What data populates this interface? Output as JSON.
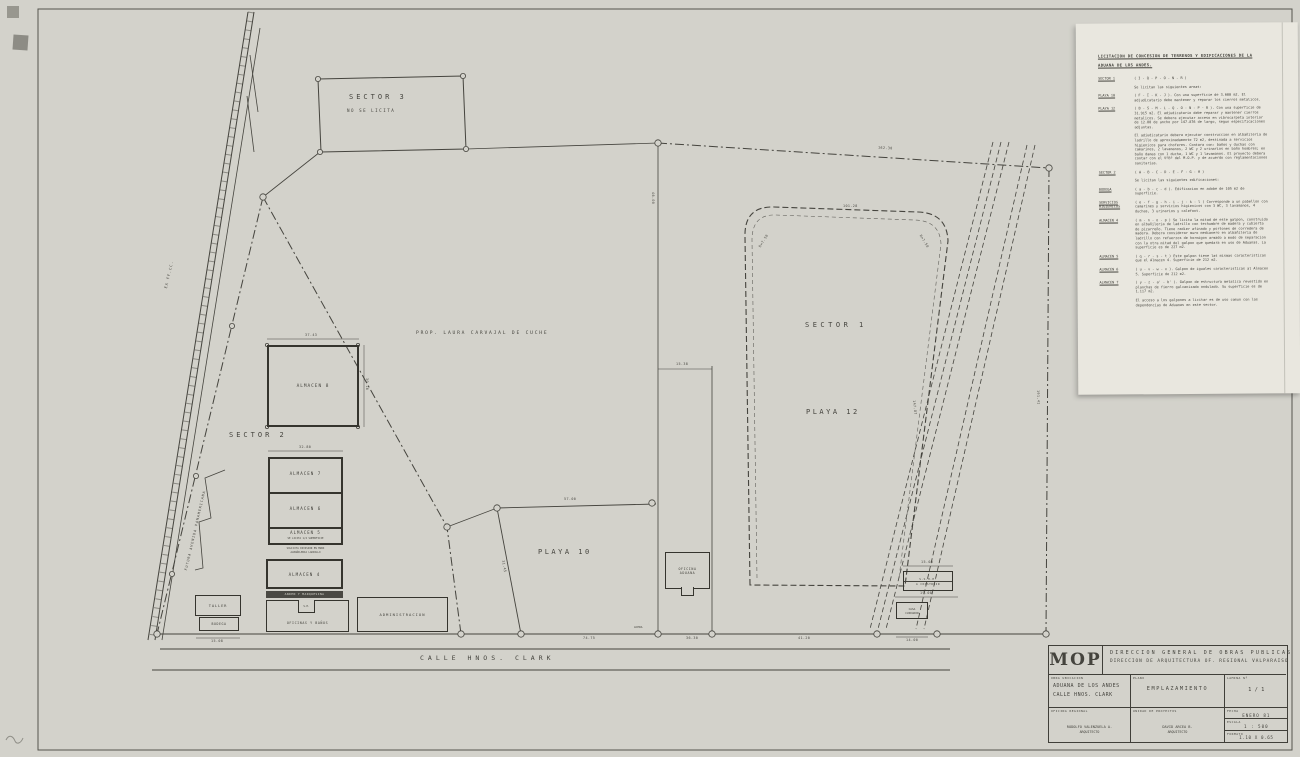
{
  "spec": {
    "title1": "LICITACION DE CONCESION DE TERRENOS Y EDIFICACIONES DE LA",
    "title2": "ADUANA DE LOS ANDES.",
    "items": [
      {
        "label": "SECTOR 1",
        "body": "( I - Q - P - O - N - R )"
      },
      {
        "label": "",
        "body": "Se licitan las siguientes areas:"
      },
      {
        "label": "PLAYA 10",
        "body": "( F - I - K - J ). Con una superficie de 3.600 m2. El adjudicatario debe mantener y reparar los cierros metalicos."
      },
      {
        "label": "PLAYA 12",
        "body": "( B - S - M - L - Q - O - N - P - R ). Con una superficie de 31.915 m2. El adjudicatario debe reparar y mantener cierros metalicos. Se debera ejecutar acceso en vibrocarpeta interior de 12.00 de ancho por 147.876 de largo, segun especificaciones adjuntas."
      },
      {
        "label": "",
        "body": "El adjudicatario debera ejecutar construccion en albañileria de ladrillo de aproximadamente 72 m2, destinada a servicios higienicos para choferes. Contara con: baños y duchas con camarines, 2 lavamanos, 2 WC y 2 urinarios en baño hombres; en baño damas con 1 ducha, 1 WC y 1 lavamanos. El proyecto debera contar con el VºBº del M.O.P. y de acuerdo con reglamentaciones sanitarias."
      },
      {
        "label": "SECTOR 2",
        "body": "( A - B - C - D - E - F - G - H )"
      },
      {
        "label": "",
        "body": "Se licitan las siguientes edificaciones:"
      },
      {
        "label": "BODEGA",
        "body": "( a - b - c - d ). Edificacion en adobe de 105 m2 de superficie."
      },
      {
        "label": "SERVICIOS HIGIENICOS",
        "body": "( e - f - g - h - i - j - k - l ) Corresponde a un pabellon con camarines y servicios higienicos con 3 WC, 3 lavamanos, 4 duchas, 3 urinarios y calefont."
      },
      {
        "label": "ALMACEN 4",
        "body": "( m - n - o - p ) Se licita la mitad de este galpon, construido en albañileria de ladrillo con techumbre de madera y cubierta de pizarreño. Tiene radier afinado y portones de corredera de madera. Debera considerar muro medianero en albañileria de ladrillo con refuerzos de hormigon armado a modo de separacion con la otra mitad del galpon que quedara en uso de Aduanas. La superficie es de 227 m2."
      },
      {
        "label": "ALMACEN 5",
        "body": "( q - r - s - t ) Este galpon tiene las mismas caracteristicas que el Almacen 4. Superficie de 212 m2."
      },
      {
        "label": "ALMACEN 6",
        "body": "( u - v - w - x ). Galpon de iguales caracteristicas al Almacen 5. Superficie de 212 m2."
      },
      {
        "label": "ALMACEN 7",
        "body": "( y - z - a' - b' ). Galpon de estructura metalica revestido en planchas de fierro galvanizado ondulado. Su superficie es de 1.117 m2."
      },
      {
        "label": "",
        "body": "El acceso a los galpones a licitar es de uso comun con las dependencias de Aduanas en este sector."
      }
    ]
  },
  "tb": {
    "logo": "MOP",
    "org1": "DIRECCION GENERAL DE OBRAS PUBLICAS",
    "org2": "DIRECCION DE ARQUITECTURA    OF. REGIONAL VALPARAISO",
    "obra_label": "OBRA  UBICACION",
    "obra1": "ADUANA DE LOS ANDES",
    "obra2": "CALLE  HNOS. CLARK",
    "plano_label": "PLANO",
    "plano": "EMPLAZAMIENTO",
    "lamina_label": "LAMINA Nº",
    "lamina": "1 / 1",
    "oficina_label": "OFICINA REGIONAL",
    "unidad_label": "UNIDAD DE PROYECTOS",
    "author1": "RODOLFO VALENZUELA A.",
    "author1_role": "ARQUITECTO",
    "author2": "DAVID ARCEA B.",
    "author2_role": "ARQUITECTO",
    "fecha_label": "FECHA",
    "fecha": "ENERO 81",
    "escala_label": "ESCALA",
    "escala": "1 : 500",
    "formato_label": "FORMATO",
    "formato": "1.10 X 0.65"
  },
  "plan": {
    "sector1": "SECTOR 1",
    "sector2": "SECTOR 2",
    "sector3": "SECTOR 3",
    "sector3_note": "NO SE LICITA",
    "playa10": "PLAYA 10",
    "playa12": "PLAYA 12",
    "prop": "PROP. LAURA CARVAJAL DE CUCHE",
    "street": "CALLE   HNOS. CLARK",
    "acera": "ACERA",
    "ex_ffcc": "EX FF.CC.",
    "avenida": "FUTURA AVENIDA PANAMERICANA",
    "almacen8": "ALMACEN 8",
    "almacen7": "ALMACEN 7",
    "almacen6": "ALMACEN 6",
    "almacen5": "ALMACEN 5",
    "almacen5_note": "SE LICITA 1/2 SUPERFICIE",
    "division_note1": "SOLICITA DIVISION EN MURO",
    "division_note2": "ALBAÑILERIA LADRILLO",
    "almacen4": "ALMACEN 4",
    "anden": "ANDEN Y MARQUESINA",
    "oficinas": "OFICINAS Y BAÑOS",
    "sh": "S.H.",
    "taller": "TALLER",
    "bodega": "BODEGA",
    "admin": "ADMINISTRACION",
    "oficina_aduana1": "OFICINA",
    "oficina_aduana2": "ADUANA",
    "sshh1": "S.S.H.H.",
    "sshh2": "A CONSTRUIR",
    "casa1": "CASA",
    "casa2": "CUIDADOR"
  },
  "dims": {
    "north_edge": "162.30",
    "a8_top": "37.43",
    "a8_right": "30.16",
    "stack_top": "32.80",
    "p10_top": "57.00",
    "p10_left": "31.45",
    "oficina_strip": "15.38",
    "divider_v": "46.00",
    "p12_top": "101.28",
    "p12_r1": "R=7.50",
    "p12_r2": "R=7.50",
    "p12_diag": "147.87",
    "east_edge": "191.41",
    "south1": "74.75",
    "south2": "36.30",
    "south3": "41.20",
    "sshh_top": "15.00",
    "sshh_bottom": "19.00",
    "casa_bottom": "14.00",
    "bodega_bottom": "15.08"
  }
}
